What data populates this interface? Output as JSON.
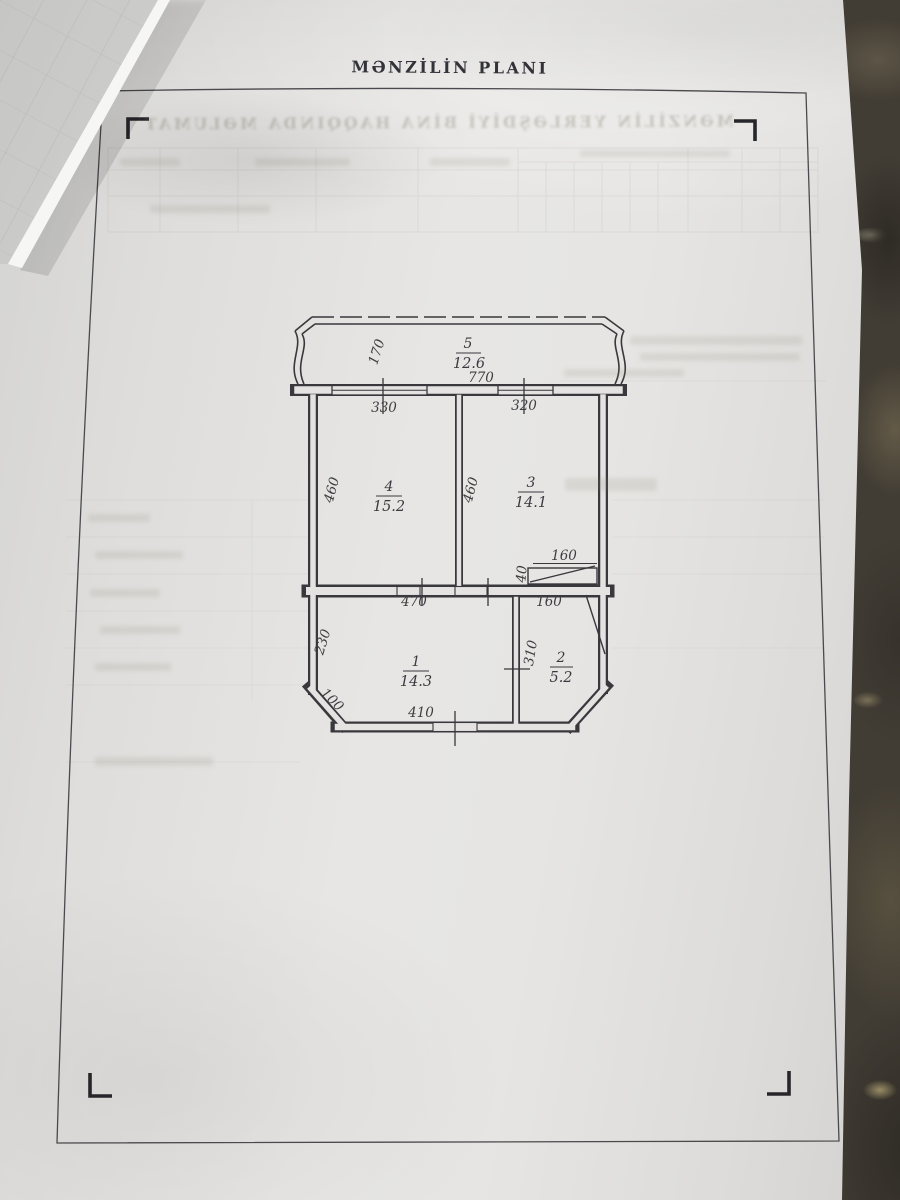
{
  "document": {
    "title": "MƏNZİLİN PLANI",
    "bleed_heading_mirrored": "MƏNZİLİN YERLƏŞDİYİ BİNA HAQQINDA MƏLUMAT"
  },
  "plan": {
    "rooms": {
      "room1": {
        "num": "1",
        "area": "14.3"
      },
      "room2": {
        "num": "2",
        "area": "5.2"
      },
      "room3": {
        "num": "3",
        "area": "14.1"
      },
      "room4": {
        "num": "4",
        "area": "15.2"
      },
      "room5": {
        "num": "5",
        "area": "12.6"
      }
    },
    "dims": {
      "balcony_depth": "170",
      "balcony_width": "770",
      "window_room4": "330",
      "window_room3": "320",
      "room4_height": "460",
      "room3_height": "460",
      "niche_width": "160",
      "niche_depth": "40",
      "room1_width": "470",
      "room2_width": "160",
      "room1_left": "230",
      "room2_height": "310",
      "corner_chamfer": "100",
      "room1_bottom": "410"
    }
  },
  "colors": {
    "ink": "#35353a",
    "paper": "#e4e3e1",
    "background": "#413c34"
  }
}
